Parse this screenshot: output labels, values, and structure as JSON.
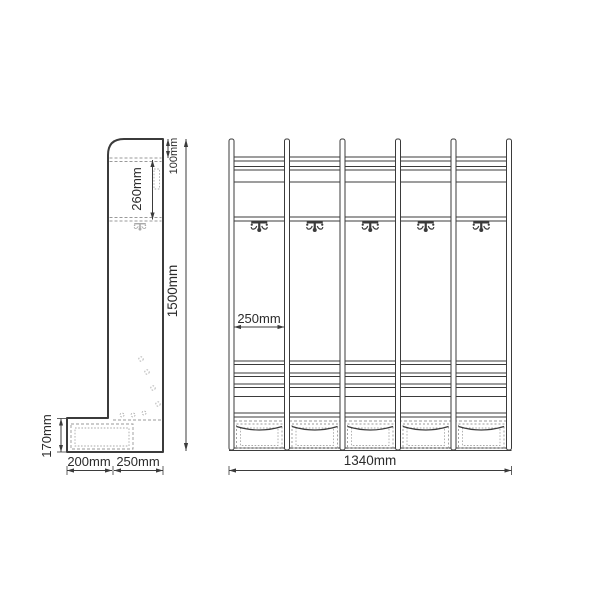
{
  "drawing_type": "furniture-dimension-diagram",
  "side_view": {
    "label": "side-profile-view",
    "dims": {
      "top_offset": "100mm",
      "hook_zone": "260mm",
      "total_height": "1500mm",
      "bench_height": "170mm",
      "bench_depth": "200mm",
      "panel_depth": "250mm"
    }
  },
  "front_view": {
    "label": "front-view",
    "dims": {
      "bay_width": "250mm",
      "total_width": "1340mm"
    },
    "post_count": 6,
    "hook_count": 5,
    "basket_count": 5
  },
  "colors": {
    "line": "#3b3b3b",
    "hidden": "#999999",
    "hidden_light": "#aaaaaa",
    "text": "#2b2b2b",
    "background": "#ffffff"
  }
}
